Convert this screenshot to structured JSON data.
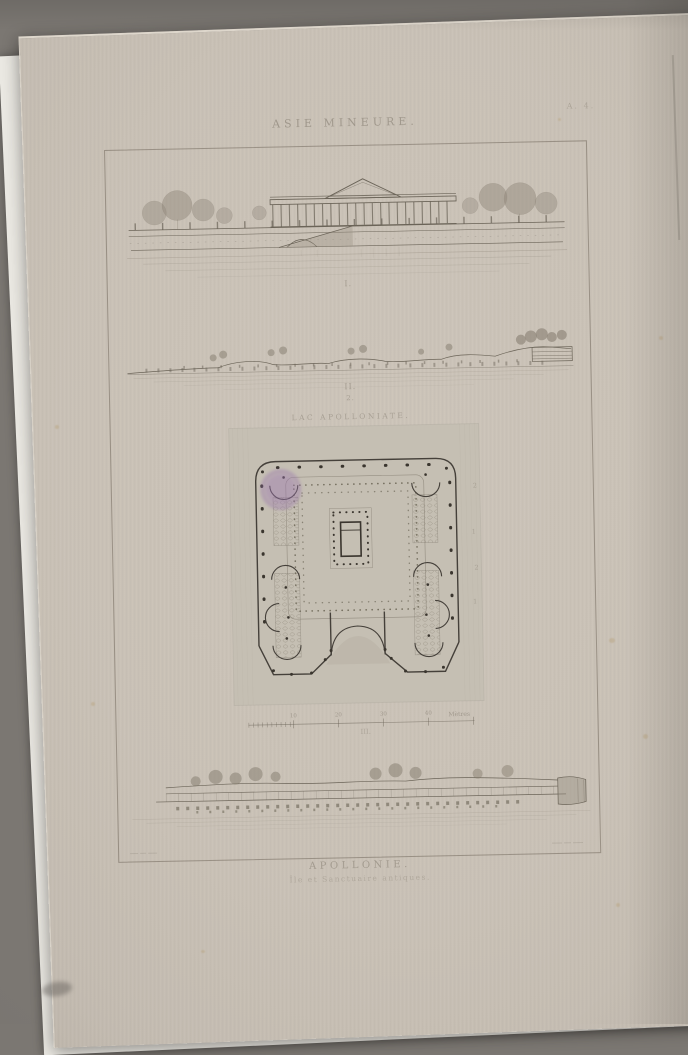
{
  "scene": {
    "backdrop_color": "#7b7772",
    "under_sheet_color": "#eae8e2",
    "paper_color": "#cac2b7",
    "stamp_color": "#9a77b1",
    "ink_color": "#6b6458"
  },
  "plate": {
    "series_title": "ASIE MINEURE.",
    "plate_mark": "A. 4.",
    "figure_labels": {
      "fig1": "I.",
      "fig2": "II.",
      "fig2_sub": "2.",
      "fig3": "III."
    },
    "map_label": "LAC APOLLONIATE.",
    "plan_margin_marks": [
      "2",
      "1",
      "2",
      "1"
    ],
    "scale_bar": {
      "tick_labels": [
        "10",
        "20",
        "30",
        "40"
      ],
      "unit_label": "Mètres"
    },
    "caption": {
      "title": "APOLLONIE.",
      "subtitle": "Île et Sanctuaire antiques."
    }
  }
}
